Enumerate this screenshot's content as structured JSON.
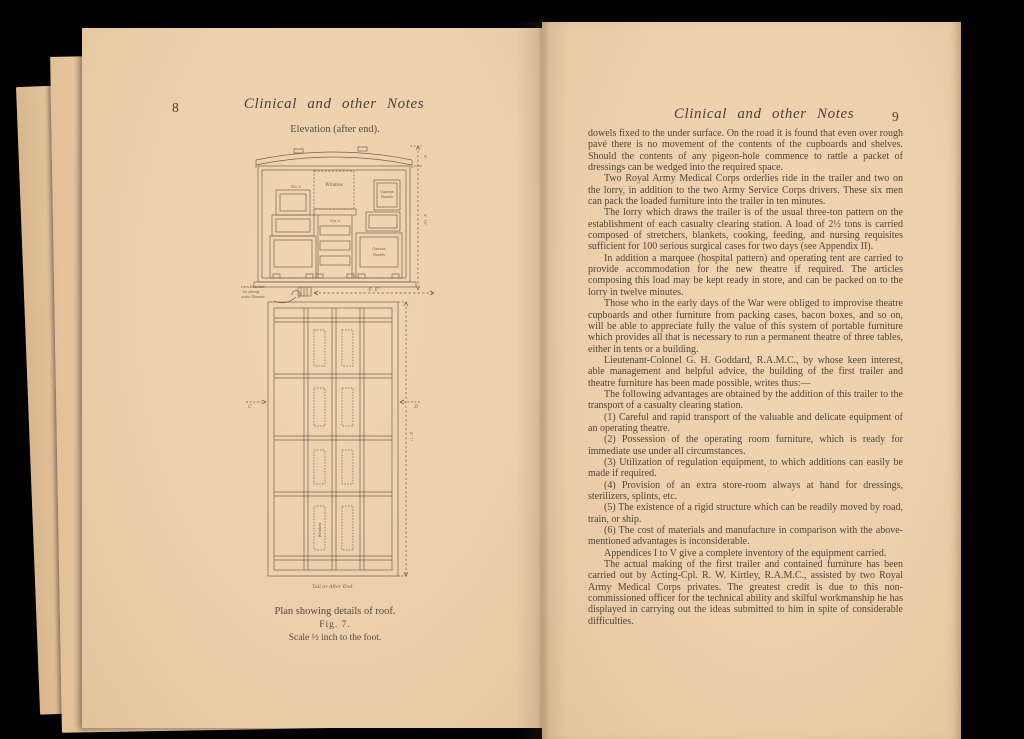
{
  "palette": {
    "background": "#020202",
    "page": "#eccfab",
    "page_edge": "#e2c09a",
    "ink": "#51453c",
    "drawing_line": "#77644f"
  },
  "left_page": {
    "page_number": "8",
    "running_header": "Clinical and other Notes",
    "figure": {
      "caption_top": "Elevation (after end).",
      "label_window_elev": "Window",
      "label_no3": "No 3",
      "label_no5": "No 5",
      "label_canvas_top_1": "Canvas",
      "label_canvas_top_2": "Panels",
      "label_canvas_bottom_1": "Canvas",
      "label_canvas_bottom_2": "Panels",
      "note_bracket_1": "Iron Bracket",
      "note_bracket_2": "to clamp",
      "note_bracket_3": "onto Chassis",
      "dim_width": "6'. 6\"",
      "dim_elev_top": "8\"",
      "dim_elev_side": "2'. 10\"",
      "dim_plan_side": "5'. 1\"",
      "label_c": "C",
      "label_d": "D",
      "label_window_plan": "Window",
      "label_tail": "Tail or After End.",
      "caption_line1": "Plan showing details of roof.",
      "caption_line2": "Fig. 7.",
      "caption_line3": "Scale ½ inch to the foot."
    }
  },
  "right_page": {
    "page_number": "9",
    "running_header": "Clinical and other Notes",
    "paragraphs": [
      "dowels fixed to the under surface.  On the road it is found that even over rough pavé there is no movement of the contents of the cupboards and shelves.   Should the contents of any pigeon-hole commence to rattle a packet of dressings can be wedged into the required space.",
      "Two Royal Army Medical Corps orderlies ride in the trailer and two on the lorry, in addition to the two Army Service Corps drivers.   These six men can pack the loaded furniture into the trailer in ten minutes.",
      "The lorry which draws the trailer is of the usual three-ton pattern on the establishment of each casualty clearing station.  A load of 2½ tons is carried composed of stretchers, blankets, cooking, feeding, and nursing requisites sufficient for 100 serious surgical cases for two days (see Appendix II).",
      "In addition a marquee (hospital pattern) and operating tent are carried to provide accommodation for the new theatre if required.  The articles composing this load may be kept ready in store, and can be packed on to the lorry in twelve minutes.",
      "Those who in the early days of the War were obliged to improvise theatre cupboards and other furniture from packing cases, bacon boxes, and so on, will be able to appreciate fully the value of this system of portable furniture which provides all that is necessary to run a permanent theatre of three tables, either in tents or a building.",
      "Lieutenant-Colonel G. H. Goddard, R.A.M.C., by whose keen interest, able management and helpful advice, the building of the first trailer and theatre furniture has been made possible, writes thus:—",
      "The following advantages are obtained by the addition of this trailer to the transport of a casualty clearing station.",
      "(1) Careful and rapid transport of the valuable and delicate equipment of an operating theatre.",
      "(2) Possession of the operating room furniture, which is ready for immediate use under all circumstances.",
      "(3) Utilization of regulation equipment, to which additions can easily be made if required.",
      "(4) Provision of an extra store-room always at hand for dressings, sterilizers, splints, etc.",
      "(5) The existence of a rigid structure which can be readily moved by road, train, or ship.",
      "(6) The cost of materials and manufacture in comparison with the above-mentioned advantages is inconsiderable.",
      "Appendices I to V give a complete inventory of the equipment carried.",
      "The actual making of the first trailer and contained furniture has been carried out by Acting-Cpl. R. W. Kirtley, R.A.M.C., assisted by two Royal Army Medical Corps privates.  The greatest credit is due to this non-commissioned officer for the technical ability and skilful workmanship he has displayed in carrying out the ideas submitted to him in spite of considerable difficulties."
    ]
  }
}
